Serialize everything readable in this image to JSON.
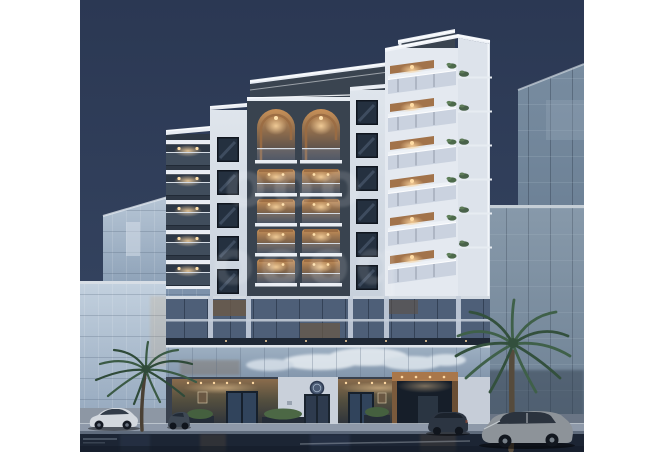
{
  "meta": {
    "type": "architectural-rendering-photo",
    "description": "Dusk rendering of a modern white residential tower with warmly lit arched balconies, LED-trimmed parapets, glass neighbor buildings, two palm trees, parked cars and a wet street. White borders left and right.",
    "time_of_day": "dusk"
  },
  "watermark": {
    "row1": "ooo",
    "row2": "oooq",
    "color": "#ffffff",
    "opacity": "0.13",
    "style": "large blurred translucent round-letter logo, two rows, centered"
  },
  "palette": {
    "sky_top": "#2b3853",
    "sky_bottom": "#3f5070",
    "facade_light": "#e3e8ef",
    "facade_shadow": "#bfc9d6",
    "dark_cladding": "#39434f",
    "warm_glow": "#c99158",
    "light_dot": "#ffdfa8",
    "wood": "#9a6b42",
    "glass_left": "#b6c5d5",
    "glass_right": "#788ca0",
    "mezzanine_glass": "#9fb1c3",
    "sidewalk": "#8e99a9",
    "street": "#1c2534",
    "palm_green": "#3f6049"
  },
  "scene": {
    "buildings": [
      "left glass tower",
      "central residential tower",
      "right glass tower with annex"
    ],
    "vehicles": [
      "white sedan",
      "grey compact car",
      "dark navy sedan",
      "silver sedan"
    ],
    "vegetation": [
      "left palm tree",
      "right palm tree",
      "entrance planters",
      "balcony plants"
    ],
    "lighting": [
      "LED parapet strips",
      "warm balcony ceiling lights",
      "entrance downlights",
      "facade uplights"
    ],
    "ground": "wet reflective asphalt street with light sidewalk curb",
    "sky": "clear deep-blue dusk sky"
  }
}
